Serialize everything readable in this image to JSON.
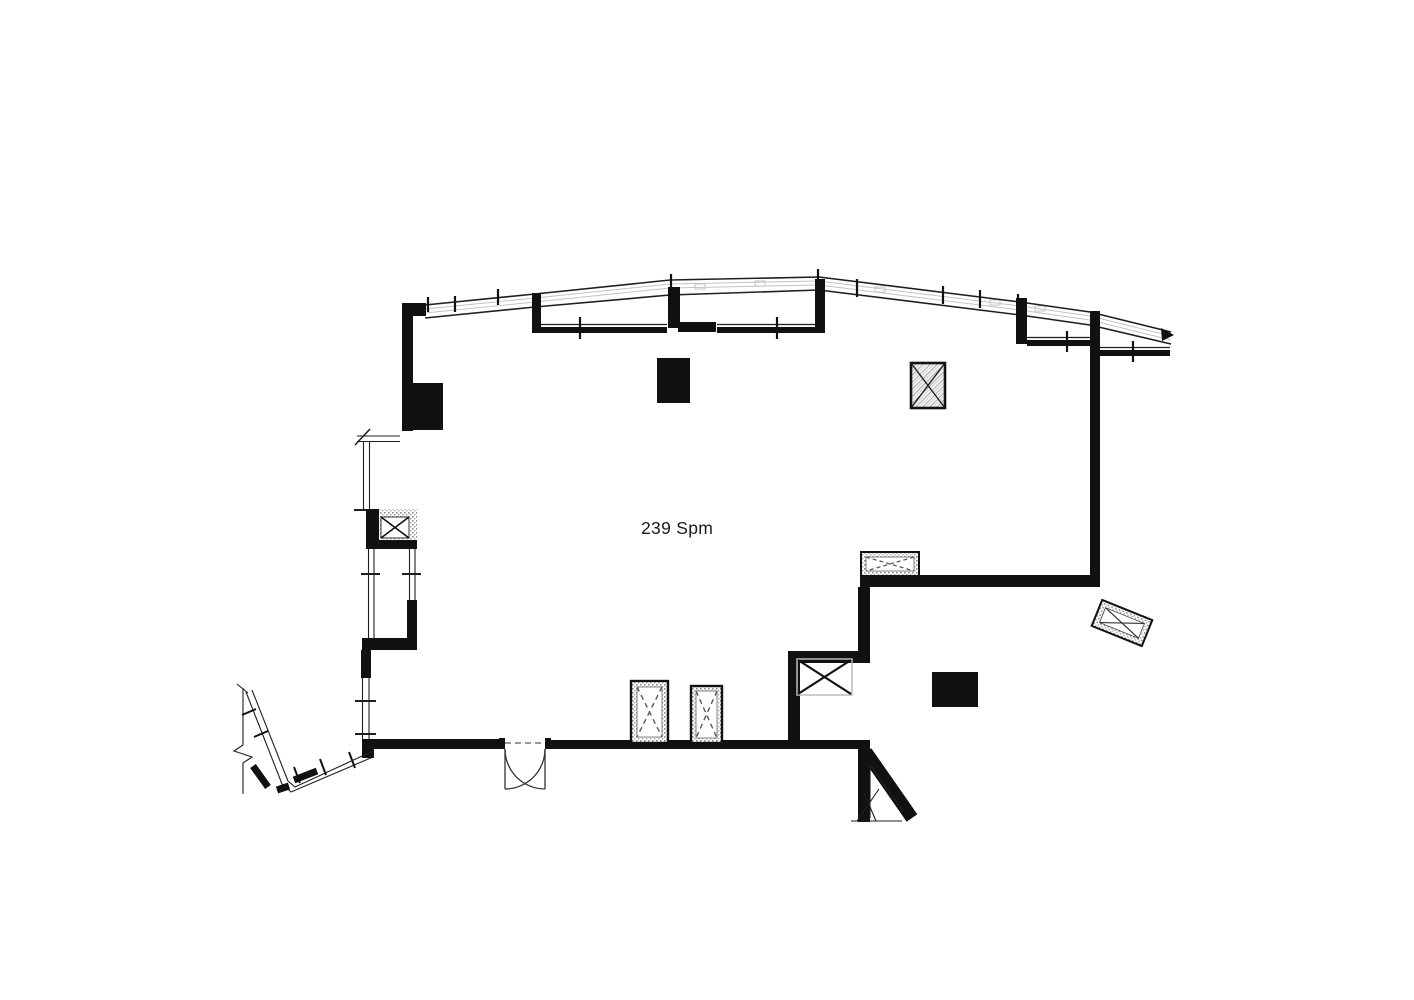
{
  "plan": {
    "area_label": "239 Spm",
    "colors": {
      "background": "#ffffff",
      "wall": "#111111",
      "line_dark": "#1f1f1f",
      "glazing": "#c4c4c4",
      "speckle": "#9a9a9a",
      "dash": "#5a5a5a",
      "light_frame": "#bcbcbc"
    }
  }
}
